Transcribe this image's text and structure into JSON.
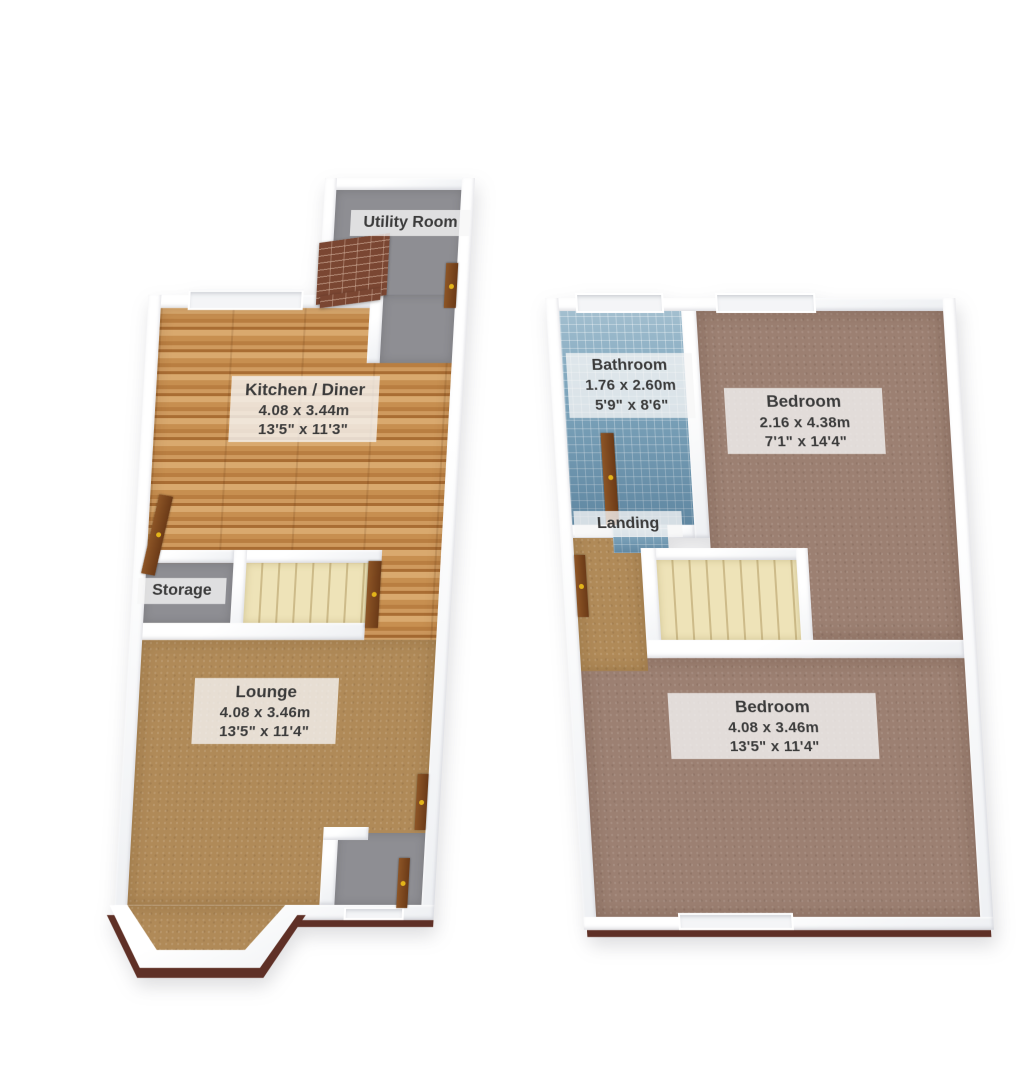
{
  "ground_floor": {
    "rooms": [
      {
        "name": "Utility Room"
      },
      {
        "name": "Kitchen / Diner",
        "dims_m": "4.08 x 3.44m",
        "dims_ft": "13'5\" x 11'3\""
      },
      {
        "name": "Storage"
      },
      {
        "name": "Lounge",
        "dims_m": "4.08 x 3.46m",
        "dims_ft": "13'5\" x 11'4\""
      }
    ]
  },
  "first_floor": {
    "rooms": [
      {
        "name": "Bathroom",
        "dims_m": "1.76 x 2.60m",
        "dims_ft": "5'9\" x 8'6\""
      },
      {
        "name": "Bedroom",
        "dims_m": "2.16 x 4.38m",
        "dims_ft": "7'1\" x 14'4\""
      },
      {
        "name": "Landing"
      },
      {
        "name": "Bedroom",
        "dims_m": "4.08 x 3.46m",
        "dims_ft": "13'5\" x 11'4\""
      }
    ]
  },
  "palette": {
    "wood": "#c68e52",
    "carpet_tan": "#b08a58",
    "carpet_pink": "#9c8072",
    "tile_blue": "#7fa6bd",
    "stairs_cream": "#eee3b8",
    "floor_gray": "#8e8e93",
    "brick": "#7a4632",
    "door_gold": "#e3b419",
    "wall_edge_brown": "#5f3026",
    "label_text": "#3b3b3b"
  }
}
